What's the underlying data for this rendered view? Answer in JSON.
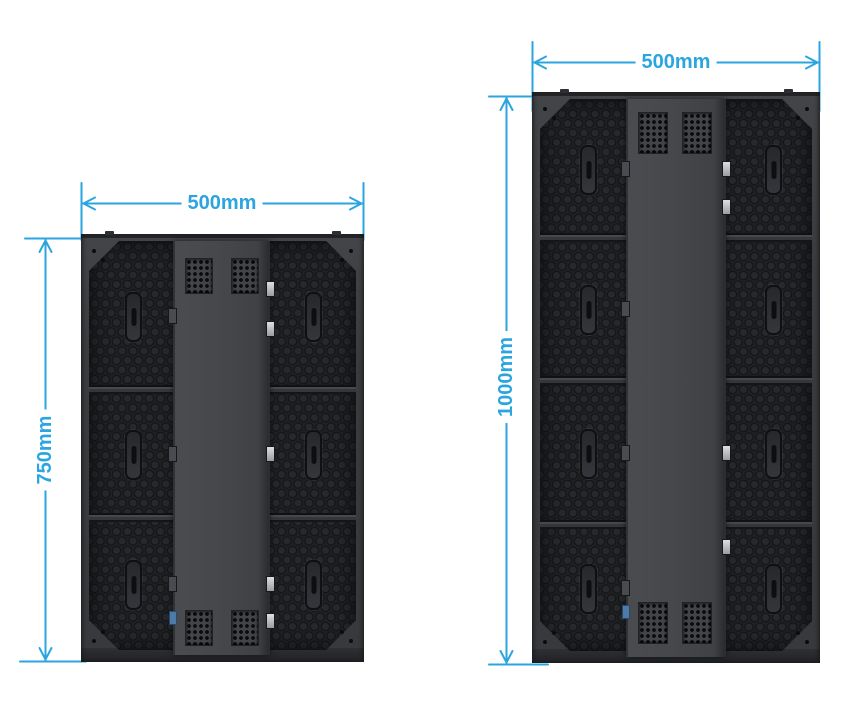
{
  "diagram": {
    "title_hint": "LED display cabinet rear-view dimension drawing",
    "accent_color": "#2BA5DF",
    "cabinet_colors": {
      "frame": "#3B3C3F",
      "back_panel": "#1F2022",
      "center_plate": "#46474B"
    },
    "panels": [
      {
        "name": "cabinet-500x750",
        "width_label": "500mm",
        "height_label": "750mm",
        "module_rows": 3
      },
      {
        "name": "cabinet-500x1000",
        "width_label": "500mm",
        "height_label": "1000mm",
        "module_rows": 4
      }
    ]
  }
}
